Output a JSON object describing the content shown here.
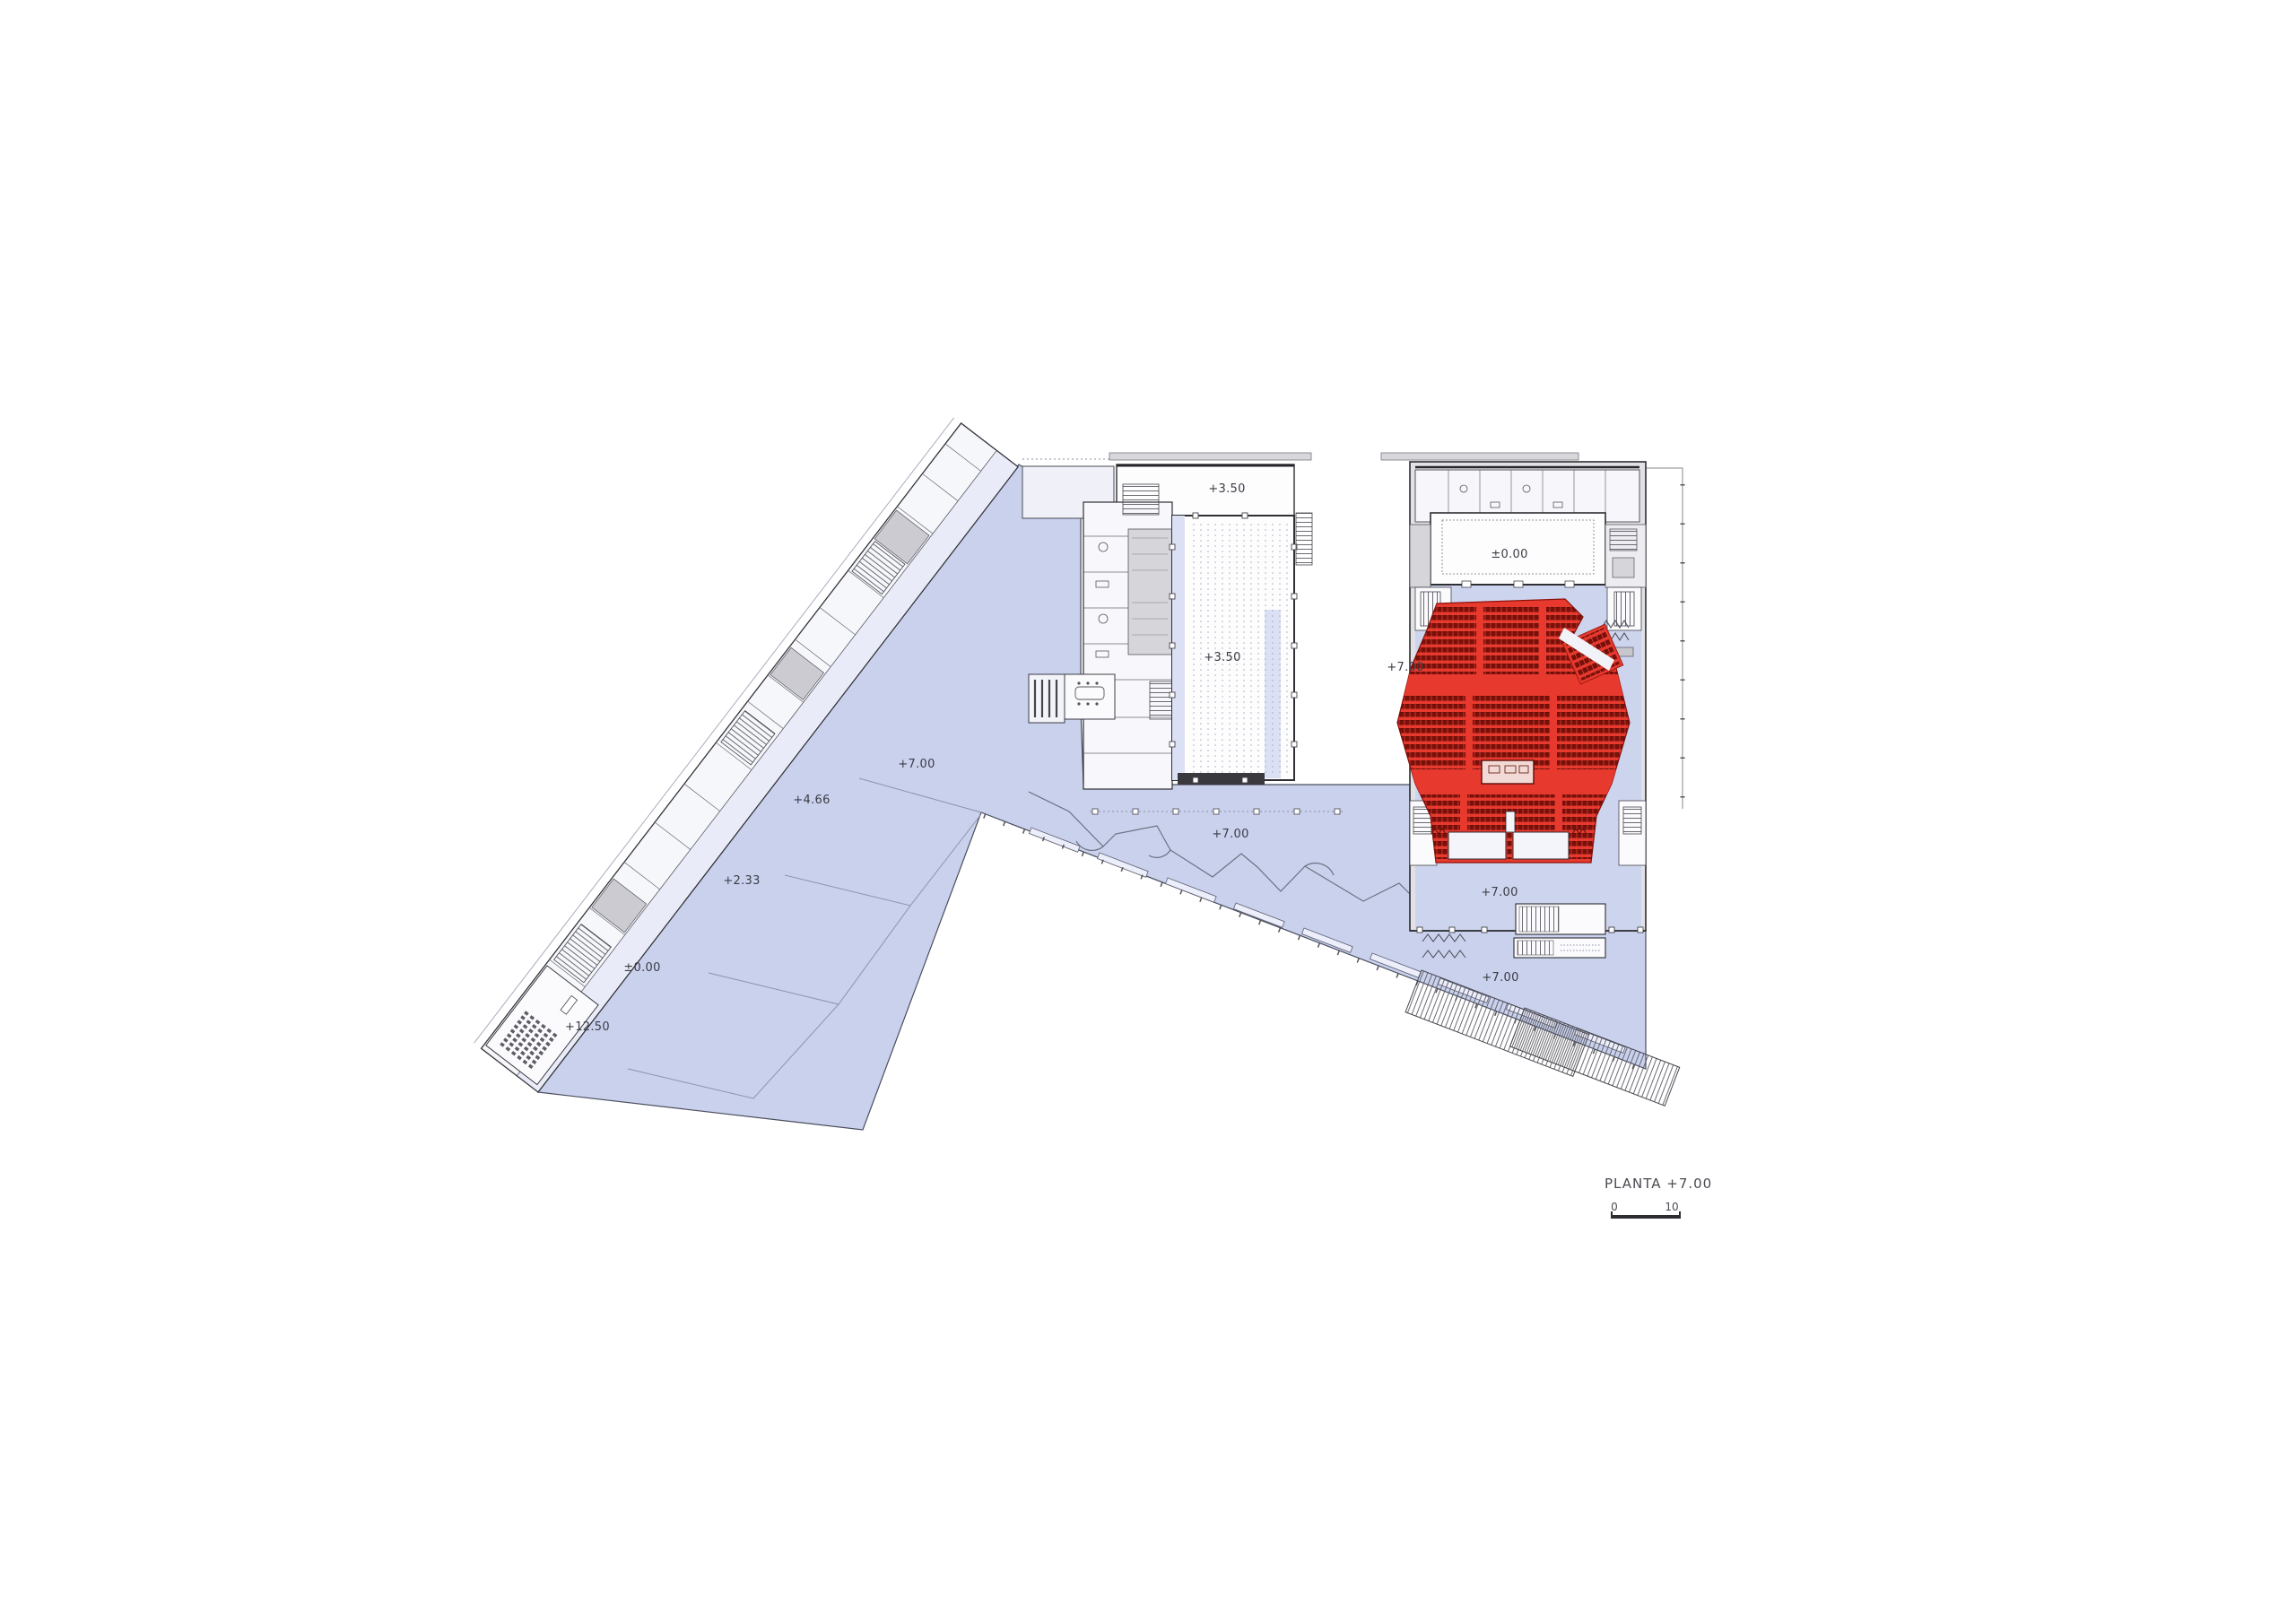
{
  "drawing": {
    "title": "PLANTA  +7.00",
    "scale_bar": {
      "start": "0",
      "end": "10"
    }
  },
  "labels": [
    {
      "id": "top-strip-level",
      "text": "+3.50"
    },
    {
      "id": "hall-level",
      "text": "+3.50"
    },
    {
      "id": "stage-level",
      "text": "±0.00"
    },
    {
      "id": "auditorium-left-level",
      "text": "+7.00"
    },
    {
      "id": "plaza-left-level",
      "text": "+7.00"
    },
    {
      "id": "ramp-level-466",
      "text": "+4.66"
    },
    {
      "id": "ramp-level-233",
      "text": "+2.33"
    },
    {
      "id": "ramp-level-000",
      "text": "±0.00"
    },
    {
      "id": "ramp-level-1250",
      "text": "+12.50"
    },
    {
      "id": "plaza-center-level",
      "text": "+7.00"
    },
    {
      "id": "foyer-level",
      "text": "+7.00"
    },
    {
      "id": "plaza-bottom-level",
      "text": "+7.00"
    }
  ],
  "colors": {
    "plaza_lavender": "#c9d1ed",
    "foyer_lavender": "#cdd4ee",
    "aisle_lavender": "#dbe0f4",
    "auditorium_red": "#e8392e",
    "seat_dark_red": "#7a1009",
    "building_gray": "#e2e2e6",
    "wall_dark": "#2e2e34"
  }
}
